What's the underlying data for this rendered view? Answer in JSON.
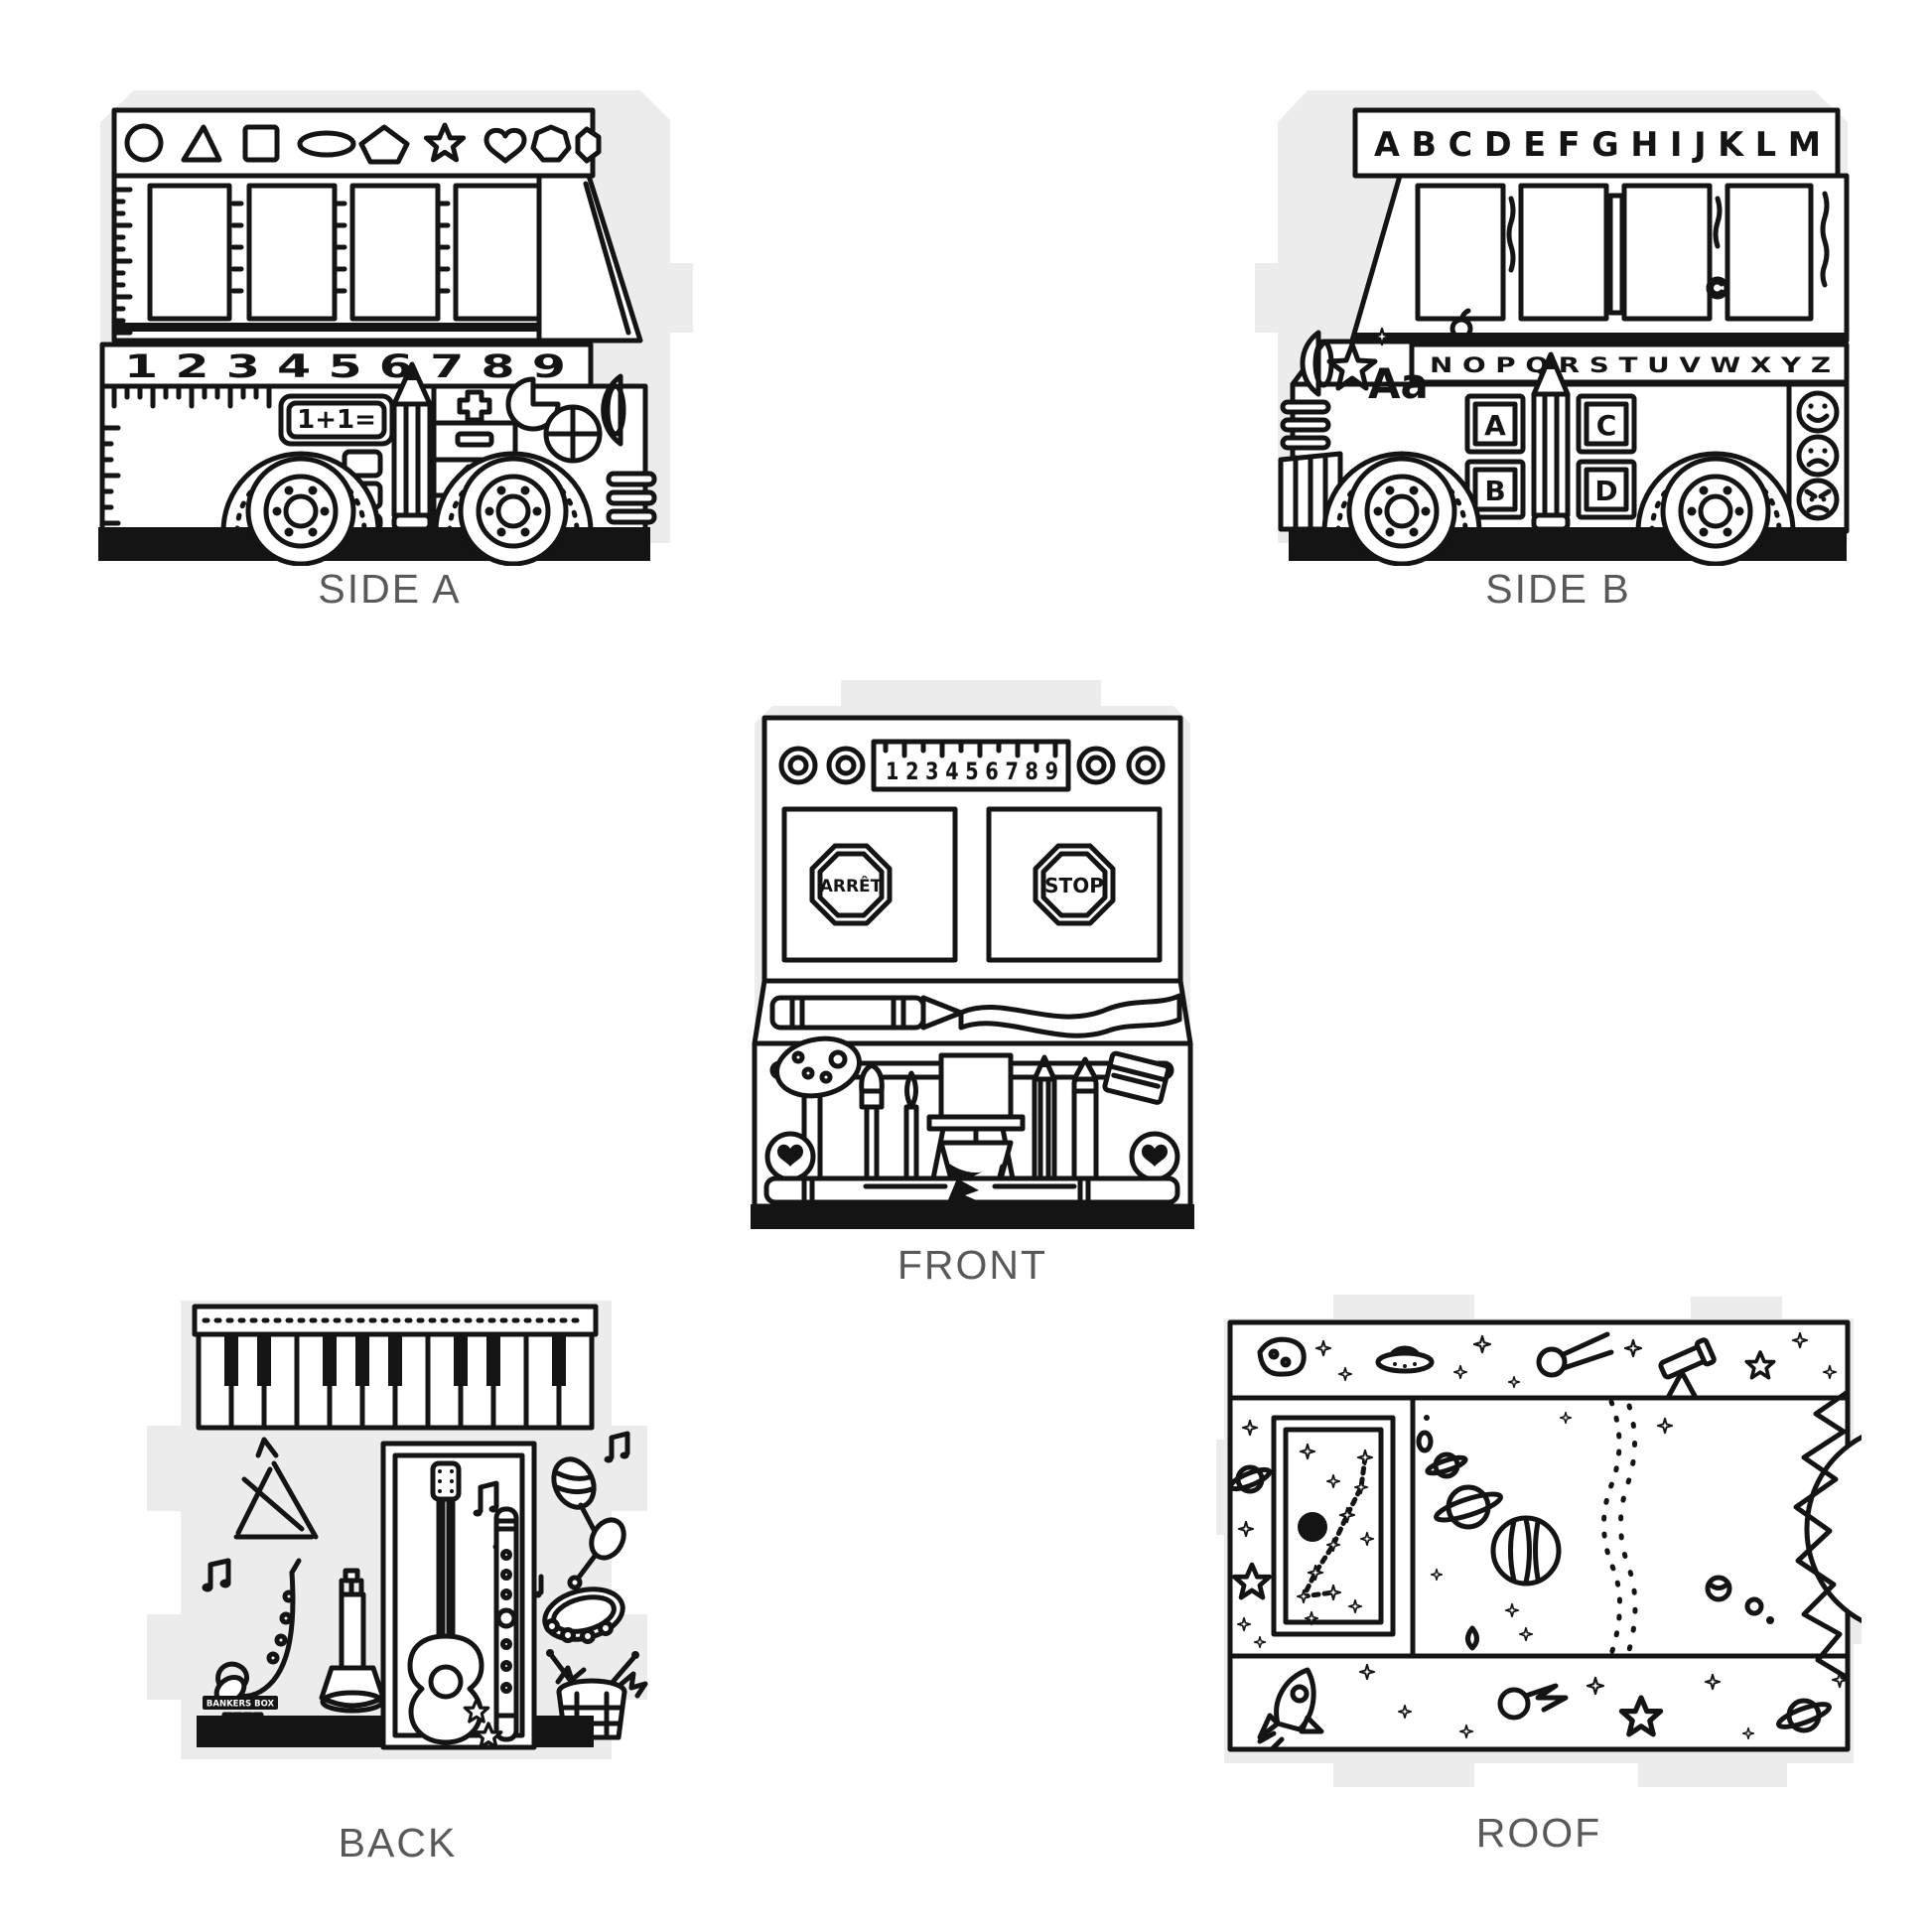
{
  "page": {
    "background": "#ffffff",
    "ink_color": "#141414",
    "cardboard_color": "#ececec",
    "label_color": "#58595b"
  },
  "panels": {
    "side_a": {
      "label": "SIDE A",
      "shapes_row": [
        "circle",
        "triangle",
        "square",
        "oval",
        "pentagon",
        "star",
        "heart",
        "heptagon",
        "gem"
      ],
      "number_strip": "1 2 3 4 5 6 7 8 9",
      "equation_badge": "1+1=",
      "math_icons": [
        "plus",
        "minus",
        "times",
        "divide"
      ],
      "decor_icons": [
        "ruler",
        "pencil",
        "fraction-circles",
        "headlight",
        "grille",
        "wheels"
      ]
    },
    "side_b": {
      "label": "SIDE B",
      "alphabet_top": "A B C D E F G H I J K L M",
      "alphabet_bottom": "N O P Q R S T U V W X Y Z",
      "writing_sample": "Aa",
      "blocks": [
        "A",
        "B",
        "C",
        "D"
      ],
      "face_icons": [
        "happy-face",
        "sad-face",
        "angry-face"
      ],
      "decor_icons": [
        "star",
        "apple",
        "pencil",
        "copyright-mark",
        "headlight",
        "wheels"
      ]
    },
    "front": {
      "label": "FRONT",
      "ruler_numbers": "1 2 3 4 5 6 7 8 9",
      "left_sign": "ARRÊT",
      "right_sign": "STOP",
      "decor_icons": [
        "lights",
        "crayon",
        "ribbon",
        "paint-palette",
        "paintbrushes",
        "easel",
        "pencil",
        "book",
        "heart-lights",
        "books",
        "bumper"
      ]
    },
    "back": {
      "label": "BACK",
      "logo_text": "BANKERS BOX",
      "instrument_icons": [
        "piano-keys",
        "triangle-instrument",
        "music-notes",
        "saxophone",
        "trumpet",
        "guitar",
        "recorder",
        "maracas",
        "tambourine",
        "drum"
      ]
    },
    "roof": {
      "label": "ROOF",
      "space_icons": [
        "asteroid",
        "flying-saucer",
        "comet",
        "telescope",
        "stars",
        "ringed-planet",
        "saturn",
        "striped-planet",
        "asteroid-belt",
        "sun",
        "constellation",
        "black-dot",
        "rocket",
        "teardrop"
      ]
    }
  }
}
